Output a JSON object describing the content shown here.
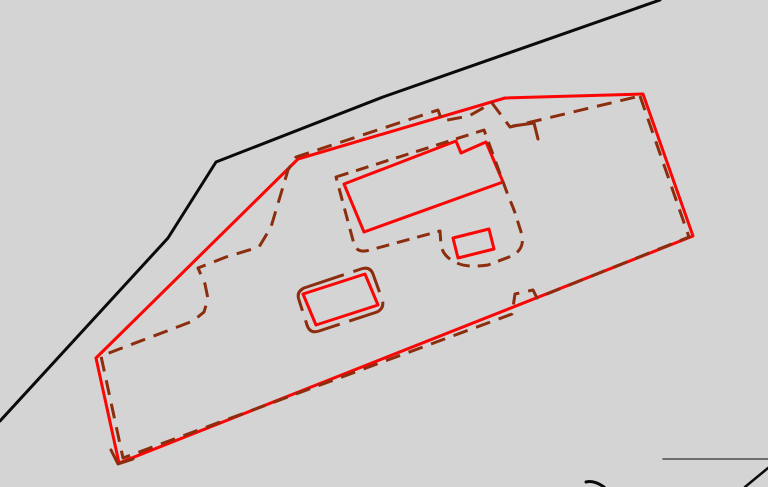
{
  "canvas": {
    "width": 768,
    "height": 487,
    "background_color": "#d4d4d4"
  },
  "palette": {
    "road_black": "#0a0a0a",
    "boundary_red": "#fb0505",
    "survey_brown": "#8c2d0e",
    "thin_gray": "#4d4d4d"
  },
  "shapes": [
    {
      "name": "road-edge-line",
      "type": "polyline",
      "stroke": "#0a0a0a",
      "width": 3,
      "points": [
        [
          660,
          0
        ],
        [
          383,
          97
        ],
        [
          216,
          162
        ],
        [
          168,
          238
        ],
        [
          0,
          421
        ]
      ]
    },
    {
      "name": "parcel-boundary-red",
      "type": "polygon",
      "stroke": "#fb0505",
      "width": 3,
      "points": [
        [
          643,
          94
        ],
        [
          693,
          236
        ],
        [
          119,
          463
        ],
        [
          96,
          358
        ],
        [
          298,
          159
        ],
        [
          505,
          98
        ]
      ]
    },
    {
      "name": "parcel-boundary-old-dashed",
      "type": "polygon",
      "stroke": "#8c2d0e",
      "width": 3,
      "dash": "15 9",
      "points": [
        [
          640,
          96
        ],
        [
          689,
          237
        ],
        [
          537,
          298
        ],
        [
          533,
          290
        ],
        [
          515,
          294
        ],
        [
          512,
          314
        ],
        [
          123,
          458
        ],
        [
          101,
          356
        ],
        [
          180,
          326
        ],
        [
          193,
          321
        ],
        [
          204,
          312
        ],
        [
          208,
          299
        ],
        [
          205,
          284
        ],
        [
          198,
          268
        ],
        [
          226,
          257
        ],
        [
          259,
          247
        ],
        [
          271,
          227
        ],
        [
          288,
          170
        ],
        [
          296,
          157
        ],
        [
          438,
          110
        ],
        [
          442,
          121
        ],
        [
          469,
          116
        ],
        [
          492,
          103
        ],
        [
          510,
          127
        ]
      ]
    },
    {
      "name": "main-building-red",
      "type": "polygon",
      "stroke": "#fb0505",
      "width": 3,
      "points": [
        [
          344,
          184
        ],
        [
          456,
          141
        ],
        [
          461,
          153
        ],
        [
          486,
          142
        ],
        [
          503,
          182
        ],
        [
          364,
          232
        ]
      ]
    },
    {
      "name": "annex-square-red",
      "type": "polygon",
      "stroke": "#fb0505",
      "width": 3,
      "points": [
        [
          453,
          238
        ],
        [
          489,
          229
        ],
        [
          494,
          249
        ],
        [
          458,
          258
        ]
      ]
    },
    {
      "name": "garage-red",
      "type": "polygon",
      "stroke": "#fb0505",
      "width": 3,
      "points": [
        [
          303,
          294
        ],
        [
          365,
          274
        ],
        [
          378,
          305
        ],
        [
          316,
          325
        ]
      ]
    },
    {
      "name": "main-building-old-dashed",
      "type": "path",
      "stroke": "#8c2d0e",
      "width": 3,
      "dash": "13 8",
      "d": "M336,177 L484,130 L509,198 Q514,209 516,216 L522,235 Q525,251 509,257 L488,265 Q468,268 457,263 Q443,257 441,245 L440,231 L370,250 Q357,254 354,244 Z"
    },
    {
      "name": "garage-old-dashed",
      "type": "path",
      "stroke": "#8c2d0e",
      "width": 3,
      "dash": "42 10",
      "d": "M304,288 L361,269 Q370,266 373,274 L382,299 Q385,308 377,312 L319,331 Q310,334 307,325 L299,300 Q296,292 304,288 Z"
    },
    {
      "name": "boundary-corner-mark-brown",
      "type": "polyline",
      "stroke": "#8c2d0e",
      "width": 3,
      "points": [
        [
          513,
          126
        ],
        [
          534,
          123
        ],
        [
          538,
          139
        ]
      ]
    },
    {
      "name": "parcel-tip-mark-brown",
      "type": "polyline",
      "stroke": "#8c2d0e",
      "width": 3,
      "points": [
        [
          111,
          450
        ],
        [
          118,
          464
        ],
        [
          133,
          459
        ]
      ]
    },
    {
      "name": "thin-line-bottom-right",
      "type": "polyline",
      "stroke": "#4d4d4d",
      "width": 1.5,
      "points": [
        [
          663,
          459
        ],
        [
          768,
          459
        ]
      ]
    },
    {
      "name": "diagonal-mark-bottom-right",
      "type": "polyline",
      "stroke": "#0a0a0a",
      "width": 2.5,
      "points": [
        [
          745,
          487
        ],
        [
          768,
          468
        ]
      ]
    },
    {
      "name": "small-mark-bottom-center",
      "type": "path",
      "stroke": "#0a0a0a",
      "width": 3,
      "d": "M586,482 Q594,480 604,487"
    }
  ]
}
